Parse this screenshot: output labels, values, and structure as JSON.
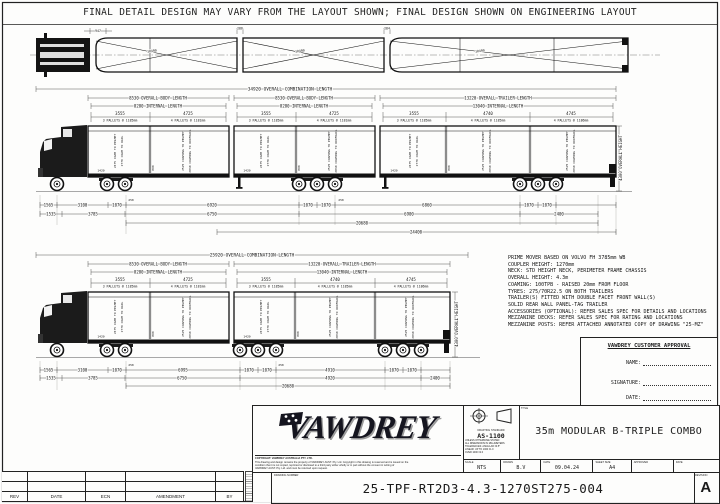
{
  "banner": "FINAL DETAIL DESIGN MAY VARY FROM THE LAYOUT SHOWN; FINAL DESIGN SHOWN ON ENGINEERING LAYOUT",
  "plan": {
    "cab_dim": "947",
    "gap1": "286",
    "gap2": "284",
    "taper": "10499"
  },
  "dims": {
    "combo_upper": "34920 OVERALL COMBINATION LENGTH",
    "combo_lower": "25920 OVERALL COMBINATION LENGTH",
    "body_len": "8530 OVERALL BODY LENGTH",
    "body_int": "8280 INTERNAL LENGTH",
    "trailer_len": "13220 OVERALL TRAILER LENGTH",
    "trailer_int": "13040 INTERNAL LENGTH",
    "seg3555": "3555",
    "seg4725": "4725",
    "seg4740": "4740",
    "seg4745": "4745",
    "height": "4300 OVERALL HEIGHT"
  },
  "notes": {
    "n3_1185": "3 PALLETS @ 1185mm",
    "n4_1181": "4 PALLETS @ 1181mm",
    "n4_1185": "4 PALLETS @ 1185mm",
    "n4_1186": "4 PALLETS @ 1186mm"
  },
  "interior": {
    "pelmetA": "2475 COAM TO PELMET",
    "railA": "2770 COAM TO RAIL",
    "pelmetB": "2525 COAMING TO PELMET",
    "railB": "2830 COAMING TO ROOFRAIL",
    "coaming": "1420",
    "mezz": "800"
  },
  "chains": {
    "t250": "250",
    "u1": [
      "1565",
      "3100",
      "1070",
      "6920",
      "1070",
      "1070",
      "6860",
      "1070",
      "1070"
    ],
    "u2": [
      "1535",
      "3785",
      "6750",
      "6900",
      "2400"
    ],
    "u3": "20680",
    "u4": "24400",
    "l1": [
      "1565",
      "3100",
      "1070",
      "6995",
      "1070",
      "1070",
      "4910",
      "1070",
      "1070"
    ],
    "l2": [
      "1535",
      "3785",
      "6750",
      "4920",
      "2400"
    ],
    "l3": "20680"
  },
  "specs": [
    "PRIME MOVER BASED ON VOLVO FH 3785mm WB",
    "COUPLER HEIGHT: 1270mm",
    "NECK: STD HEIGHT NECK, PERIMETER FRAME CHASSIS",
    "OVERALL HEIGHT: 4.3m",
    "COAMING: 100TPB - RAISED 20mm FROM FLOOR",
    "TYRES: 275/70R22.5 ON BOTH TRAILERS",
    "TRAILER(S) FITTED WITH DOUBLE FACET FRONT WALL(S)",
    "SOLID REAR WALL PANEL-TAG TRAILER",
    "ACCESSORIES (OPTIONAL): REFER SALES SPEC FOR DETAILS AND LOCATIONS",
    "MEZZANINE DECKS: REFER SALES SPEC FOR RATING AND LOCATIONS",
    "MEZZANINE POSTS: REFER ATTACHED ANNOTATED COPY OF DRAWING \"25-MZ\""
  ],
  "approval": {
    "title": "VAWDREY CUSTOMER APPROVAL",
    "name": "NAME:",
    "signature": "SIGNATURE:",
    "date": "DATE:"
  },
  "revtable": {
    "headers": [
      "REV",
      "DATE",
      "ECN",
      "AMENDMENT",
      "BY"
    ]
  },
  "logo": {
    "brand": "VAWDREY",
    "copy0": "COPYRIGHT: VAWDREY AUSTRALIA PTY. LTD.",
    "copy1": "This drawing and design remains the property of VAWDREY AUST. Pty. Ltd. Copyright in this drawing is reserved and is issued on the",
    "copy2": "condition that it is not copied, reprinted or disclosed to a third party either wholly or in part without the consent in writing of",
    "copy3": "VAWDREY AUST. Pty. Ltd. and must be returned upon request."
  },
  "titleblock": {
    "standard_label": "DRAFTING STANDARD",
    "standard": "AS-1100",
    "tol0": "UNLESS OTHERWISE STATED",
    "tol1": "ALL DIMENSIONS IN MILLIMETERS",
    "tol2": "TOLERANCES: ANGULAR ±0.5°",
    "tol3": "LINEAR: UP TO 1000 ±1.0",
    "tol4": "OVER 1000 ±2.0",
    "title_label": "TITLE",
    "title": "35m MODULAR B-TRIPLE COMBO",
    "scale_label": "SCALE",
    "scale": "NTS",
    "drawn_label": "DRAWN",
    "drawn": "B.V",
    "date_label": "DATE",
    "date": "09.04.24",
    "sheet_label": "SHEET SIZE",
    "sheet": "A4",
    "approved_label": "APPROVED",
    "approved_date_label": "DATE",
    "number_label": "DRAWING NUMBER",
    "number": "25-TPF-RT2D3-4.3-1270ST275-004",
    "revision_label": "REVISION",
    "revision": "A"
  }
}
